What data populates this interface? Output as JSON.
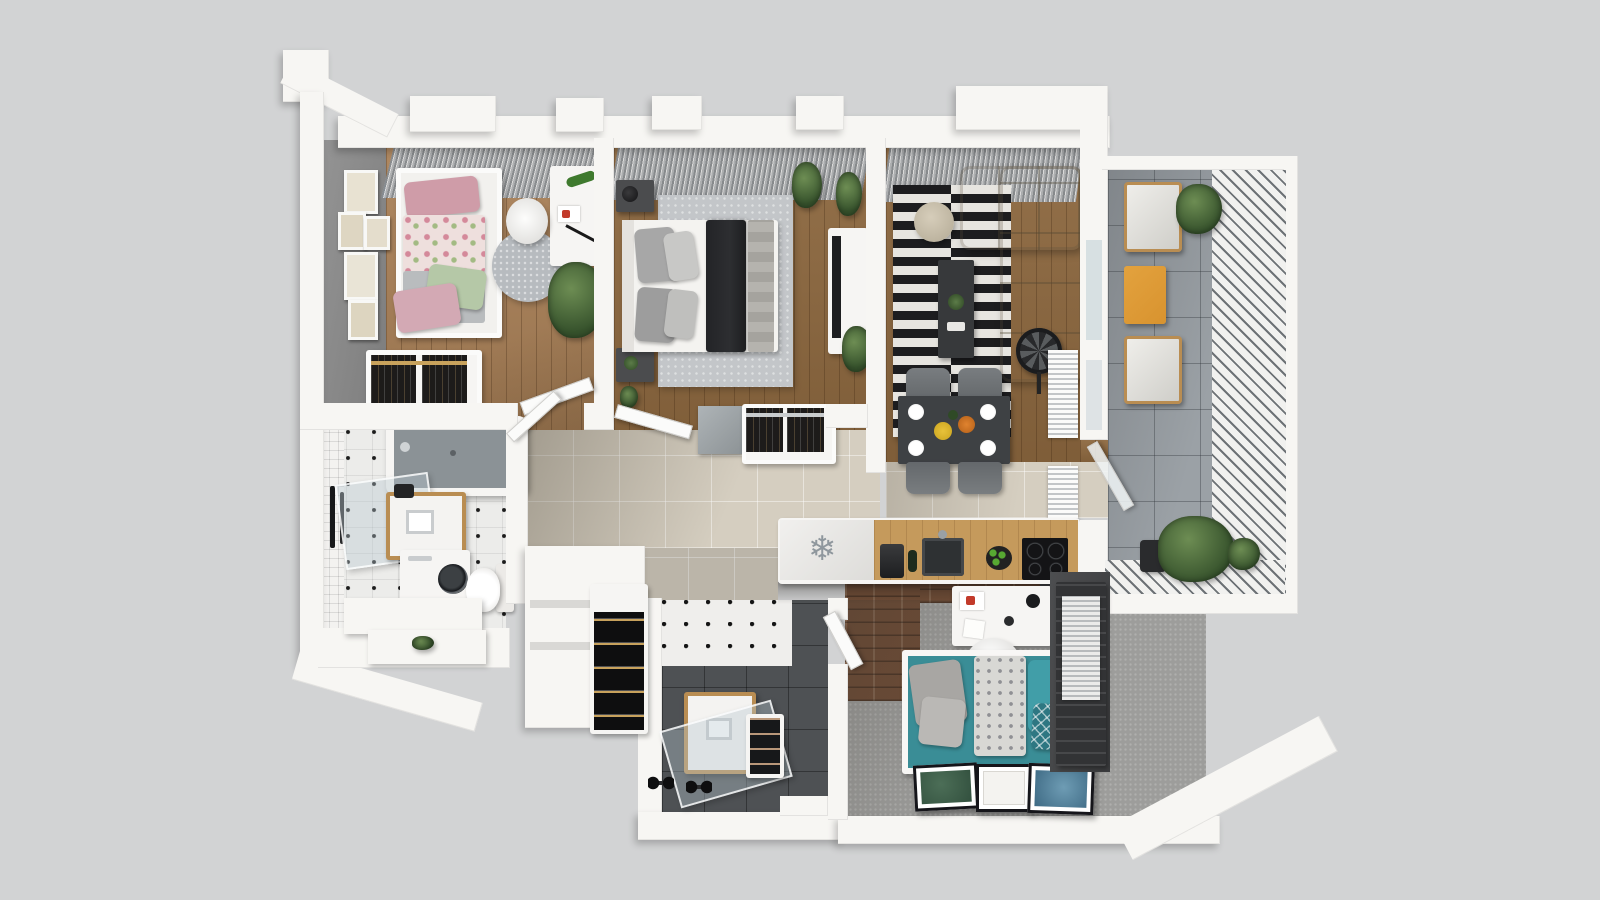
{
  "scene": {
    "type": "3d-apartment-floor-plan-render",
    "view": "top-down-axonometric",
    "visible_text": "none"
  },
  "palette": {
    "bg": "#d2d3d4",
    "wall": "#f7f6f3",
    "accent-wall": "#8d8d8d",
    "wood-light": "#aa8158",
    "wood-dark": "#8d683f",
    "hall-tile": "#d5cec0",
    "balcony-tile": "#9ba1a6",
    "dark-tile": "#4e5154",
    "carpet": "#9d9d9b",
    "bath-tile": "#ececea",
    "rug-gray": "#b7bbbf",
    "stripe-black": "#1d1d1f",
    "stripe-white": "#e7e5e0",
    "sofa-beige": "#c9c0ac",
    "teal": "#3a8d96",
    "teal-deep": "#2e7782",
    "pink": "#cf9ca8",
    "pink-light": "#eedfdd",
    "green-pillow": "#b5c8a7",
    "brick": "#6e4c36",
    "dark-furn": "#3a3b3d",
    "orange-table": "#d8932f",
    "cooktop-black": "#141416",
    "apple-green": "#57a832"
  },
  "icons": {
    "snowflake": "❄"
  },
  "rooms": [
    {
      "id": "kids-bedroom",
      "floor": "light-wood",
      "furniture": [
        "single-bed-floral",
        "pink-pillows",
        "green-pillow",
        "round-rug",
        "white-desk",
        "desk-chair",
        "toy-lizard",
        "potted-plant",
        "wardrobe-clothes",
        "wall-art-frames",
        "window-curtains",
        "gray-accent-wall"
      ]
    },
    {
      "id": "master-bedroom",
      "floor": "dark-wood",
      "furniture": [
        "double-bed",
        "black-throw",
        "gray-pillows",
        "area-rug",
        "nightstand-top",
        "nightstand-bottom",
        "table-lamp",
        "potted-plants",
        "mirror-panel",
        "wardrobe-clothes",
        "window-curtains"
      ]
    },
    {
      "id": "living-room",
      "floor": "dark-wood",
      "furniture": [
        "corner-sofa",
        "striped-rug",
        "coffee-table",
        "pouf",
        "tv-stand",
        "tv",
        "floor-fan",
        "potted-plants",
        "radiator-upper",
        "radiator-lower",
        "window-curtains"
      ]
    },
    {
      "id": "dining-area",
      "floor": "beige-tile",
      "furniture": [
        "dining-table",
        "four-chairs",
        "plates",
        "lemon-plate",
        "fruit-bowl"
      ]
    },
    {
      "id": "kitchen",
      "floor": "beige-tile",
      "furniture": [
        "fridge-snowflake",
        "wood-counter",
        "coffee-machine",
        "wine-bottle",
        "sink",
        "apple-bowl",
        "cooktop-4-burners"
      ]
    },
    {
      "id": "bathroom",
      "floor": "white-tile-black-dots",
      "furniture": [
        "bathtub",
        "shower-glass",
        "towel-rail",
        "vanity-sink",
        "washing-machine",
        "toilet",
        "step-platform",
        "plant-sprig",
        "wall-niche"
      ]
    },
    {
      "id": "hallway",
      "floor": "beige-tile",
      "furniture": [
        "open-door-kids",
        "open-door-master",
        "open-door-bathroom",
        "wine-rack",
        "entry-platform"
      ]
    },
    {
      "id": "shower-room",
      "floor": "dark-gray-tile",
      "furniture": [
        "vanity-sink",
        "glass-screen",
        "dumbbells",
        "shoe-rack",
        "dotted-tile-wall"
      ]
    },
    {
      "id": "home-office",
      "floor": "gray-carpet",
      "furniture": [
        "white-desk",
        "desk-chair",
        "daybed-teal",
        "gray-pillows",
        "teal-pillows",
        "patterned-blanket",
        "floor-art-green",
        "floor-art-white",
        "floor-art-blue",
        "dark-wardrobe",
        "radiator",
        "brick-accent-wall"
      ]
    },
    {
      "id": "balcony",
      "floor": "gray-tile",
      "furniture": [
        "lounge-chair-top",
        "lounge-chair-bottom",
        "orange-side-table",
        "potted-plant-top",
        "potted-plants-bottom",
        "diagonal-privacy-screen"
      ]
    }
  ]
}
